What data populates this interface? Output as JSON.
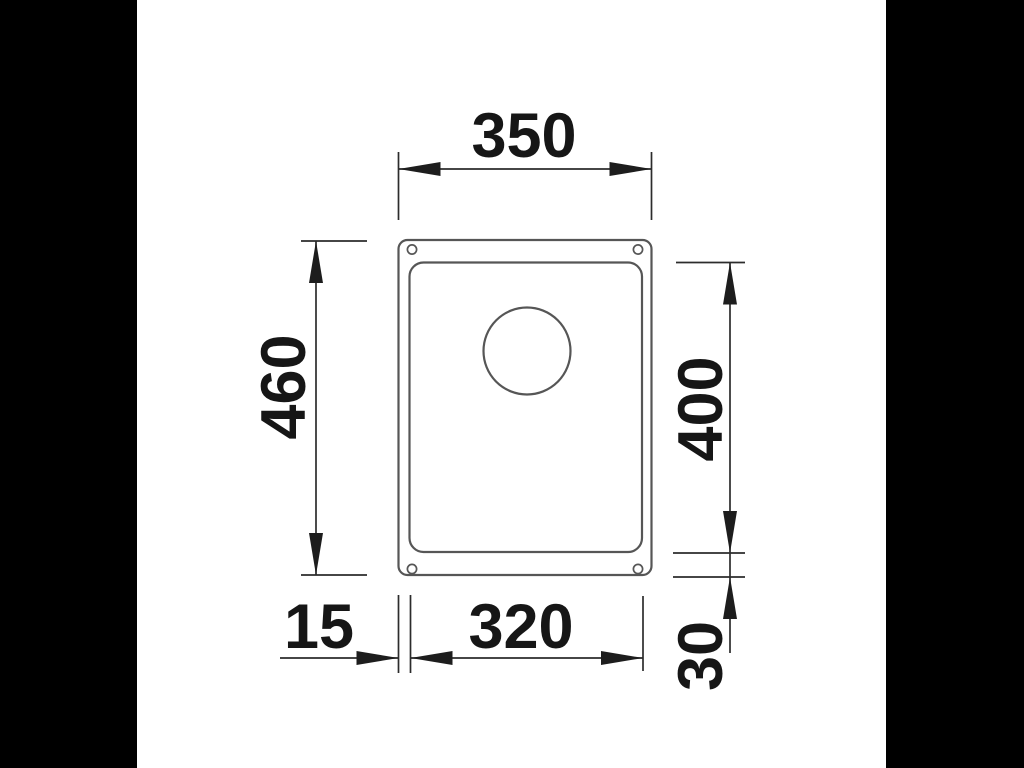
{
  "page": {
    "background_color": "#000000",
    "sheet_color": "#ffffff"
  },
  "drawing": {
    "subject": "undermount sink top view technical drawing",
    "outline_color": "#565656",
    "dimension_line_color": "#2c2c2c",
    "text_color": "#161616"
  },
  "dimensions": {
    "overall_width": "350",
    "overall_depth": "460",
    "bowl_depth": "400",
    "left_rim_width": "15",
    "bowl_width": "320",
    "bottom_rim_depth": "30"
  }
}
